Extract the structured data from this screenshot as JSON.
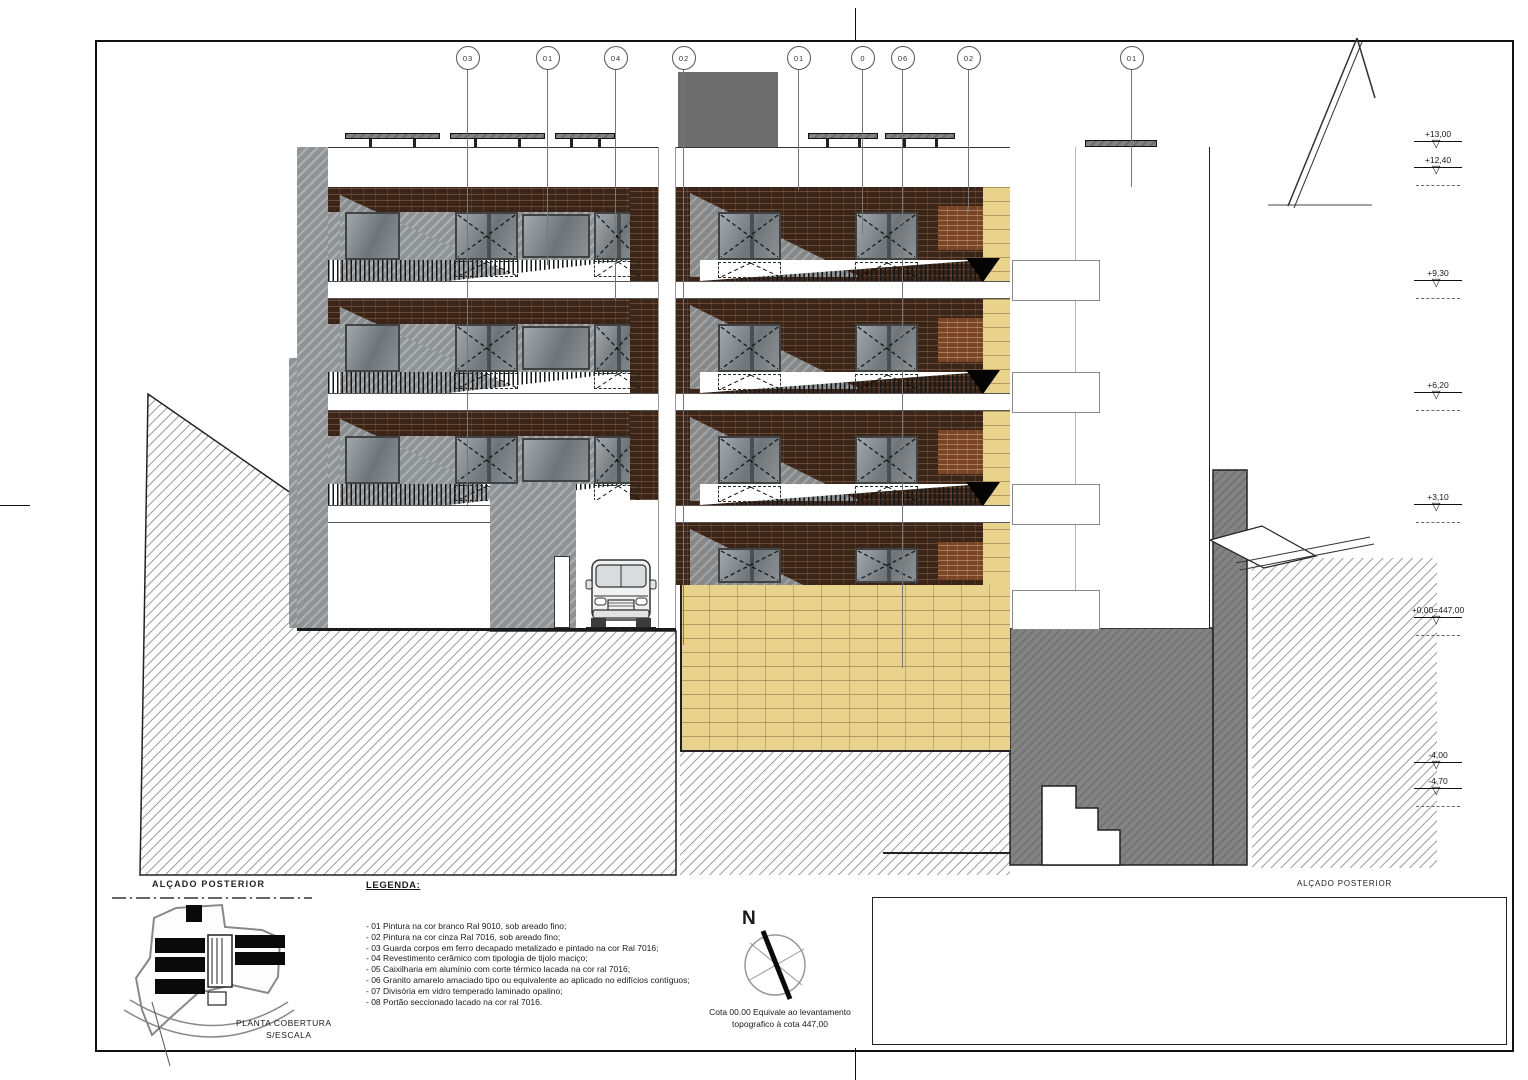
{
  "title_labels": {
    "elevation_name_left": "ALÇADO POSTERIOR",
    "elevation_name_right": "ALÇADO POSTERIOR",
    "roof_plan_title": "PLANTA COBERTURA",
    "roof_plan_scale": "S/ESCALA"
  },
  "legend": {
    "title": "LEGENDA:",
    "items": [
      "- 01 Pintura na cor branco Ral 9010, sob areado fino;",
      "- 02 Pintura na cor cinza Ral 7016, sob areado fino;",
      "- 03 Guarda corpos em ferro decapado metalizado e pintado na cor Ral 7016;",
      "- 04 Revestimento cerâmico com tipologia de tijolo maciço;",
      "- 05 Caixilharia em alumínio com corte térmico lacada na cor ral 7016;",
      "- 06 Granito amarelo amaciado  tipo ou equivalente ao aplicado no edifícios contíguos;",
      "- 07 Divisória em vidro temperado laminado opalino;",
      "- 08 Portão seccionado lacado na cor ral 7016."
    ]
  },
  "levels_note": {
    "line1": "Cota 00.00 Equivale ao levantamento",
    "line2": "topografico à cota 447,00"
  },
  "compass": {
    "label": "N"
  },
  "callouts": [
    "03",
    "01",
    "04",
    "02",
    "01",
    "0",
    "06",
    "02",
    "01"
  ],
  "elevation_markers": [
    "+13,00",
    "+12,40",
    "+9,30",
    "+6,20",
    "+3,10",
    "+0,00=447,00",
    "-4,00",
    "-4,70"
  ],
  "colors": {
    "brick": "#3a2518",
    "brick_light": "#7a4527",
    "granite": "#e8d28c",
    "glass_gray": "#84898d",
    "wall_gray": "#8f9396",
    "dark_mass": "#848484",
    "box_gray": "#6e6e6e",
    "line": "#1a1a1a"
  }
}
